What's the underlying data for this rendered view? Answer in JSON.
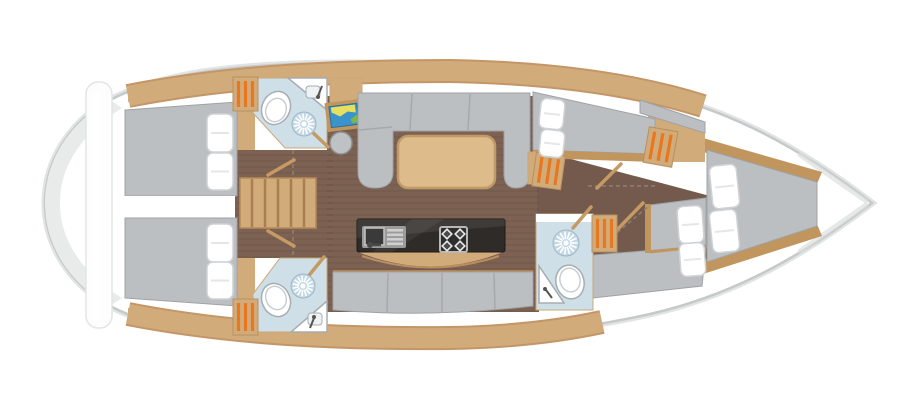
{
  "diagram": {
    "type": "sailing-yacht-interior-floor-plan",
    "view": "top-down",
    "orientation": "bow-right-stern-left",
    "rooms": [
      {
        "id": "aft-cabin-port",
        "features": [
          "double-berth",
          "2-pillows",
          "wood-battens"
        ]
      },
      {
        "id": "aft-cabin-starboard",
        "features": [
          "double-berth",
          "2-pillows",
          "wood-battens"
        ]
      },
      {
        "id": "aft-head-port",
        "features": [
          "toilet",
          "shower",
          "corner-sink",
          "door"
        ]
      },
      {
        "id": "aft-head-starboard",
        "features": [
          "toilet",
          "shower",
          "corner-sink",
          "door"
        ]
      },
      {
        "id": "companionway",
        "features": [
          "stairs-5-treads"
        ]
      },
      {
        "id": "saloon",
        "features": [
          "u-settee",
          "dining-table",
          "side-settee"
        ]
      },
      {
        "id": "nav-station",
        "features": [
          "chart-table-with-map",
          "round-stool",
          "cabinet"
        ]
      },
      {
        "id": "galley",
        "features": [
          "sink-with-drainer",
          "stove-4-burners",
          "curved-counter-front"
        ]
      },
      {
        "id": "forward-head",
        "features": [
          "toilet",
          "shower",
          "corner-sink",
          "door"
        ]
      },
      {
        "id": "port-forward-cabin",
        "features": [
          "berth",
          "2-pillows",
          "louvered-locker"
        ]
      },
      {
        "id": "starboard-forward-cabin",
        "features": [
          "angled-berth",
          "2-pillows",
          "louvered-locker"
        ]
      },
      {
        "id": "bow-cabin",
        "features": [
          "double-berth",
          "2-pillows",
          "wood-trim"
        ]
      }
    ],
    "counts": {
      "berths": 5,
      "pillows": 10,
      "heads": 3,
      "louvered_lockers": 5,
      "stair_treads": 5,
      "stove_burners": 4
    }
  },
  "palette": {
    "hull_fill": "#ffffff",
    "hull_stroke": "#c5c9c9",
    "hull_shadow": "#e2e4e4",
    "stern_shade": "#e9ebeb",
    "wood": "#d2ab7b",
    "wood_dark": "#c1955e",
    "floor": "#7d6253",
    "floor_dark": "#745a4c",
    "cushion": "#bcbfc1",
    "pillow": "#ffffff",
    "head_floor": "#cfdfe8",
    "shower_blue": "#c3d8e4",
    "locker_orange": "#e87820",
    "counter_black": "#2f2b29",
    "steel_grey": "#9b9b9b",
    "table_wood": "#ddbb8a",
    "map_sea": "#3b93cc",
    "map_land_yellow": "#e6e05e",
    "map_land_green": "#7cb648",
    "transom_white": "#fdfdfd"
  }
}
